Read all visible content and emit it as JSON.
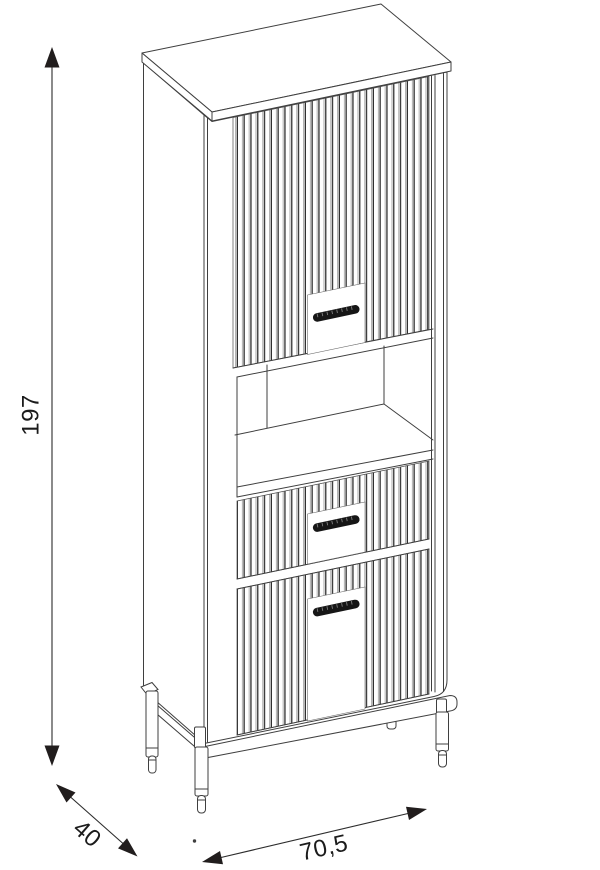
{
  "figure": {
    "description": "Isometric line drawing of a tall fluted cabinet with one door, an open shelf niche, two drawers and round metal legs"
  },
  "dimensions": {
    "height": "197",
    "depth": "40",
    "width": "70,5"
  },
  "colors": {
    "background": "#ffffff",
    "line": "#3f3f3f",
    "flute_shadow": "#2e2e2e",
    "handle": "#161616",
    "dimension_text": "#1b1b1b"
  }
}
